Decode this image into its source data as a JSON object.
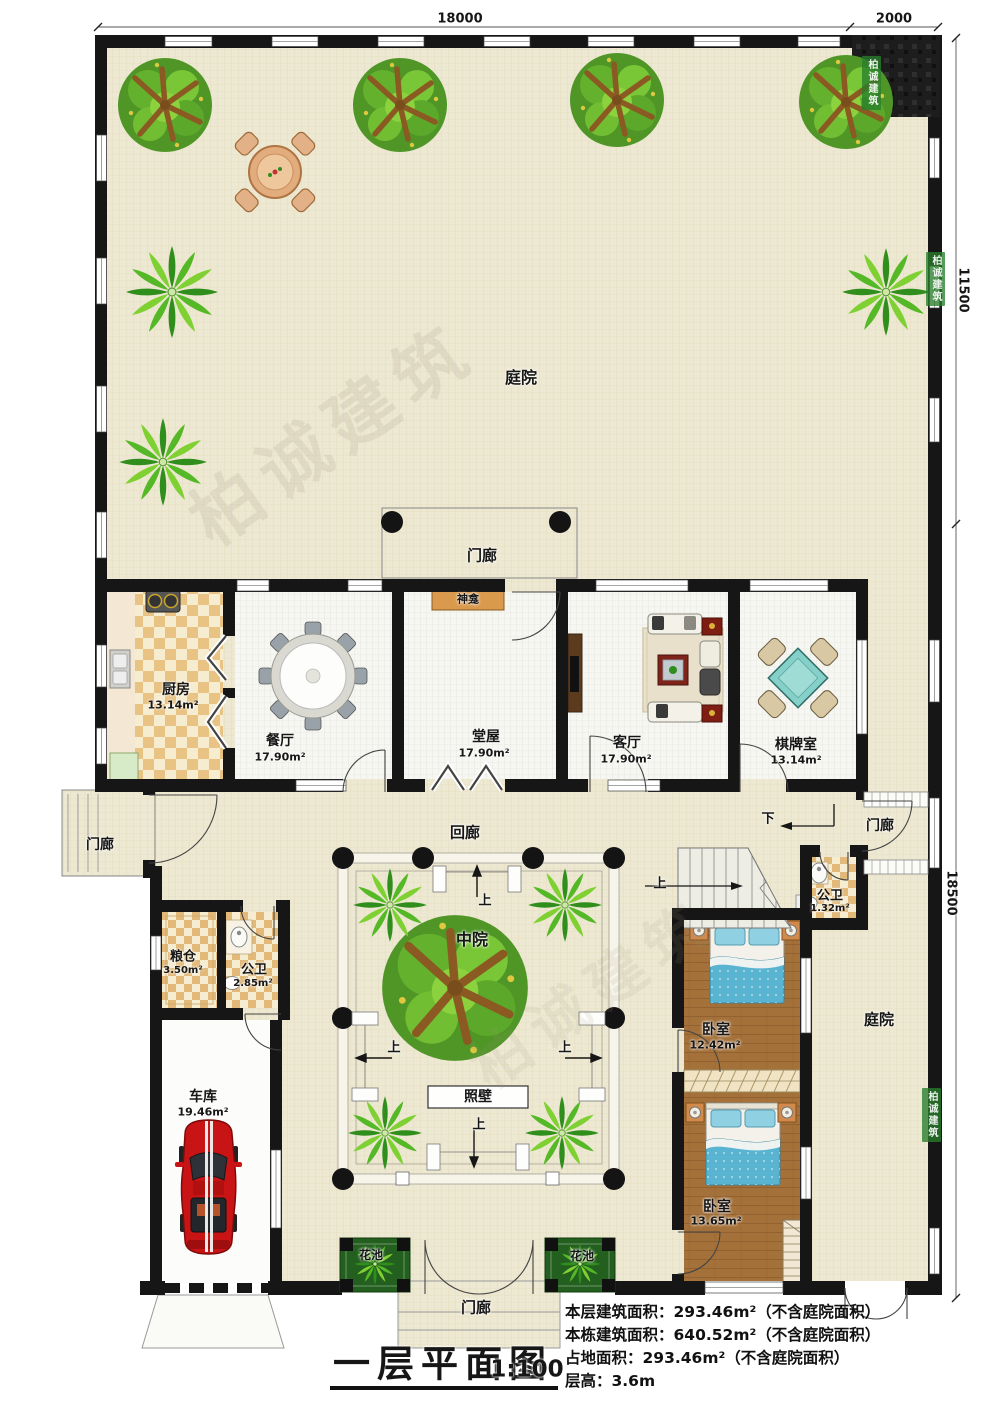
{
  "dimensions": {
    "top": "18000",
    "top_right": "2000",
    "right_upper": "11500",
    "right_lower": "18500"
  },
  "labels": {
    "courtyard_top": "庭院",
    "courtyard_right": "庭院",
    "porch": "门廊",
    "corridor": "回廊",
    "mid_court": "中院",
    "screen_wall": "照壁",
    "shrine": "神龛",
    "flower_bed": "花池",
    "up": "上",
    "down": "下"
  },
  "rooms": {
    "kitchen": {
      "name": "厨房",
      "area": "13.14m²"
    },
    "dining": {
      "name": "餐厅",
      "area": "17.90m²"
    },
    "hall": {
      "name": "堂屋",
      "area": "17.90m²"
    },
    "living": {
      "name": "客厅",
      "area": "17.90m²"
    },
    "chess": {
      "name": "棋牌室",
      "area": "13.14m²"
    },
    "granary": {
      "name": "粮仓",
      "area": "3.50m²"
    },
    "wc_small": {
      "name": "公卫",
      "area": "2.85m²"
    },
    "wc_mini": {
      "name": "公卫",
      "area": "1.32m²"
    },
    "garage": {
      "name": "车库",
      "area": "19.46m²"
    },
    "bedroom_a": {
      "name": "卧室",
      "area": "12.42m²"
    },
    "bedroom_b": {
      "name": "卧室",
      "area": "13.65m²"
    }
  },
  "title": {
    "text": "一层平面图",
    "scale": "1:100"
  },
  "notes": [
    "本层建筑面积：293.46m²（不含庭院面积）",
    "本栋建筑面积：640.52m²（不含庭院面积）",
    "占地面积：293.46m²（不含庭院面积）",
    "层高：3.6m"
  ],
  "watermark": "柏诚建筑",
  "colors": {
    "wall": "#161616",
    "floor_court": "#EDE8D2",
    "floor_room": "#F6F6F2",
    "floor_wood": "#A5713A",
    "bed": "#58B4D0",
    "mahjong": "#86D0CA",
    "car": "#C81414",
    "flower_bed": "#235F1F"
  }
}
